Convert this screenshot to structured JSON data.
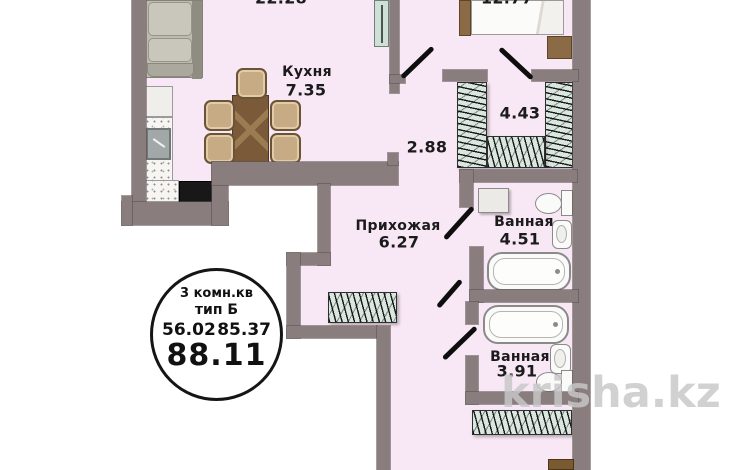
{
  "plan": {
    "watermark": "krisha.kz",
    "rooms": {
      "living": {
        "area": "22.28"
      },
      "bedroom": {
        "area": "12.77"
      },
      "kitchen": {
        "name": "Кухня",
        "area": "7.35"
      },
      "corridor": {
        "area": "2.88"
      },
      "closet": {
        "area": "4.43"
      },
      "hallway": {
        "name": "Прихожая",
        "area": "6.27"
      },
      "bathroom_top": {
        "name": "Ванная",
        "area": "4.51"
      },
      "bathroom_bottom": {
        "name": "Ванная",
        "area": "3.91"
      }
    },
    "stamp": {
      "type_line1": "3 комн.кв",
      "type_line2": "тип Б",
      "area_left": "56.02",
      "area_right": "85.37",
      "area_total": "88.11"
    },
    "colors": {
      "wall": "#8a7d7d",
      "floor": "#f8e7f5",
      "wardrobe_fill": "#d9e7df",
      "furniture_wood": "#7a5a38",
      "door_leaf": "#cfe0d8",
      "label_text": "#1b1b1b",
      "watermark_text": "#c8c8c8"
    }
  }
}
